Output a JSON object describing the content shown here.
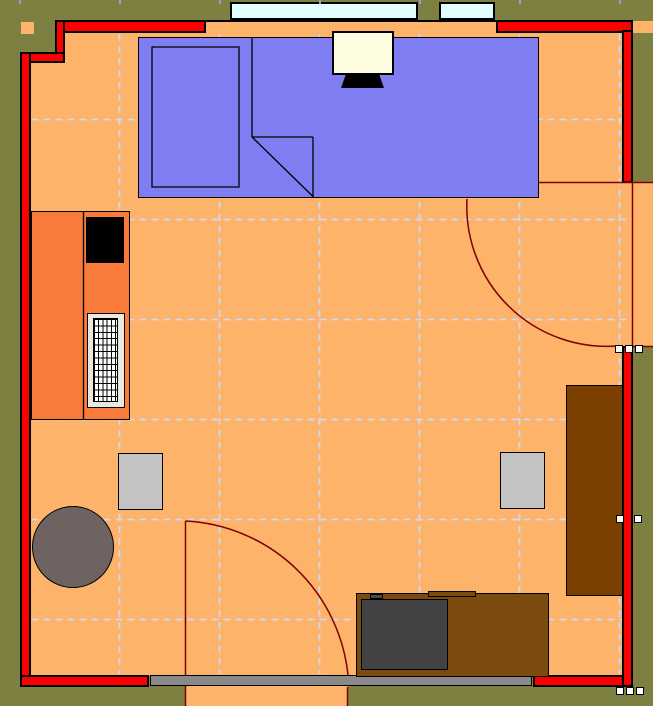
{
  "title": "Room floor plan",
  "canvas": {
    "w": 653,
    "h": 706,
    "bg": "#7d8041"
  },
  "palette": {
    "outside": "#7d8041",
    "floor": "#fdb36a",
    "wall_red": "#fa0000",
    "wall_outline": "#000000",
    "door_line": "#7f0000",
    "grid_line": "#cfd8f6",
    "ruler_tick": "#8f9ce8",
    "window_glass": "#e1ffff",
    "desk_blue": "#7e7ef2",
    "cabinet_orange": "#f87b3a",
    "wood_dark": "#7b4000",
    "wood_mid": "#7b4a0e",
    "chair_gray": "#c3c3c3",
    "tv_gray": "#424242",
    "table_taupe": "#6f6361",
    "monitor_cream": "#fffde1",
    "radiator_body": "#e9e9e0",
    "sill_gray": "#898989",
    "outlet_white": "#ffffff"
  },
  "floor_regions": [
    {
      "name": "floor-main",
      "inter": false,
      "x": 64,
      "y": 33,
      "w": 558.5,
      "h": 643,
      "fill": "#fdb36a",
      "bw": 0
    },
    {
      "name": "floor-left-strip",
      "inter": false,
      "x": 30.5,
      "y": 62,
      "w": 33.5,
      "h": 614,
      "fill": "#fdb36a",
      "bw": 0
    },
    {
      "name": "window-sill-band",
      "inter": false,
      "x": 203,
      "y": 21.5,
      "w": 294,
      "h": 15.5,
      "fill": "#fdb36a",
      "bw": 0
    },
    {
      "name": "doorway-right-floor",
      "inter": false,
      "x": 622,
      "y": 182,
      "w": 31,
      "h": 165,
      "fill": "#fdb36a",
      "bw": 0
    },
    {
      "name": "doorway-bottom-floor",
      "inter": false,
      "x": 185,
      "y": 686,
      "w": 163,
      "h": 20,
      "fill": "#fdb36a",
      "bw": 0
    },
    {
      "name": "floor-sliver-top-right",
      "inter": false,
      "x": 633,
      "y": 21,
      "w": 20,
      "h": 12,
      "fill": "#fdb36a",
      "bw": 0
    },
    {
      "name": "floor-square-top-left",
      "inter": false,
      "x": 20.5,
      "y": 21.5,
      "w": 13,
      "h": 12.5,
      "fill": "#fdb36a",
      "bw": 0
    }
  ],
  "grid": {
    "color": "#cfd8f6",
    "dash": "7 5",
    "width": 1.8,
    "v": [
      {
        "x": 119.5,
        "y1": 34,
        "y2": 674
      },
      {
        "x": 219.5,
        "y1": 34,
        "y2": 674
      },
      {
        "x": 319.5,
        "y1": 34,
        "y2": 674
      },
      {
        "x": 419.5,
        "y1": 34,
        "y2": 674
      },
      {
        "x": 519.5,
        "y1": 34,
        "y2": 674
      },
      {
        "x": 619.5,
        "y1": 34,
        "y2": 674
      }
    ],
    "h": [
      {
        "y": 119.5,
        "x1": 31.5,
        "x2": 622
      },
      {
        "y": 219.5,
        "x1": 31.5,
        "x2": 632
      },
      {
        "y": 319.5,
        "x1": 31.5,
        "x2": 632
      },
      {
        "y": 419.5,
        "x1": 31.5,
        "x2": 622
      },
      {
        "y": 519.5,
        "x1": 31.5,
        "x2": 622
      },
      {
        "y": 619.5,
        "x1": 31.5,
        "x2": 622
      }
    ]
  },
  "ruler_ticks": {
    "color": "#8f9ce8",
    "y": 0,
    "w": 2,
    "h": 4,
    "xs": [
      18.5,
      118.5,
      218.5,
      318.5,
      418.5,
      518.5,
      618.5
    ]
  },
  "walls": [
    {
      "name": "wall-top-left-segment",
      "inter": false,
      "x": 54.5,
      "y": 19.5,
      "w": 151,
      "h": 13,
      "fill": "#fa0000",
      "bw": 2
    },
    {
      "name": "wall-top-right-segment",
      "inter": false,
      "x": 496,
      "y": 19.5,
      "w": 137,
      "h": 13.5,
      "fill": "#fa0000",
      "bw": 2
    },
    {
      "name": "wall-corner-step-vertical",
      "inter": false,
      "x": 54.5,
      "y": 19.5,
      "w": 10,
      "h": 43,
      "fill": "#fa0000",
      "bw": 2
    },
    {
      "name": "wall-corner-step-horizontal",
      "inter": false,
      "x": 20,
      "y": 51.5,
      "w": 44.5,
      "h": 11,
      "fill": "#fa0000",
      "bw": 2
    },
    {
      "name": "wall-left",
      "inter": false,
      "x": 20,
      "y": 51.5,
      "w": 10.5,
      "h": 635.5,
      "fill": "#fa0000",
      "bw": 2
    },
    {
      "name": "wall-bottom-left-segment",
      "inter": false,
      "x": 20,
      "y": 674.5,
      "w": 128.5,
      "h": 12.5,
      "fill": "#fa0000",
      "bw": 2
    },
    {
      "name": "wall-bottom-right-segment",
      "inter": false,
      "x": 532.5,
      "y": 674.5,
      "w": 100,
      "h": 12.5,
      "fill": "#fa0000",
      "bw": 2
    },
    {
      "name": "wall-right-upper",
      "inter": false,
      "x": 621.5,
      "y": 30,
      "w": 11,
      "h": 152.5,
      "fill": "#fa0000",
      "bw": 2
    },
    {
      "name": "wall-right-lower",
      "inter": false,
      "x": 621.5,
      "y": 345.5,
      "w": 11,
      "h": 341.5,
      "fill": "#fa0000",
      "bw": 2
    },
    {
      "name": "window-band-top-border",
      "inter": false,
      "x": 203,
      "y": 19.5,
      "w": 294,
      "h": 2,
      "fill": "#000000",
      "bw": 0
    },
    {
      "name": "bottom-threshold-sill",
      "inter": false,
      "x": 149.5,
      "y": 674.5,
      "w": 382,
      "h": 11.5,
      "fill": "#898989",
      "bw": 1.5
    }
  ],
  "windows": [
    {
      "name": "window-large",
      "inter": true,
      "x": 229.5,
      "y": 1.5,
      "w": 188,
      "h": 18.5,
      "fill": "#e1ffff",
      "bw": 2
    },
    {
      "name": "window-small",
      "inter": true,
      "x": 439,
      "y": 1.5,
      "w": 56,
      "h": 18.5,
      "fill": "#e1ffff",
      "bw": 2
    }
  ],
  "furniture": [
    {
      "name": "desk-workstation",
      "inter": true,
      "x": 137.5,
      "y": 36.5,
      "w": 401,
      "h": 161,
      "fill": "#7e7ef2",
      "bw": 1.5
    },
    {
      "name": "monitor-screen",
      "inter": true,
      "x": 331.5,
      "y": 30.5,
      "w": 62,
      "h": 44,
      "fill": "#fffde1",
      "bw": 2
    },
    {
      "name": "cabinet-left",
      "inter": true,
      "x": 30.5,
      "y": 210.5,
      "w": 99,
      "h": 209,
      "fill": "#f87b3a",
      "bw": 1.5
    },
    {
      "name": "cabinet-black-box",
      "inter": false,
      "x": 85.5,
      "y": 216.5,
      "w": 38,
      "h": 46,
      "fill": "#000000",
      "bw": 0
    },
    {
      "name": "radiator-body",
      "inter": true,
      "x": 87,
      "y": 312.5,
      "w": 37.5,
      "h": 95,
      "fill": "#e9e9e0",
      "bw": 1.5
    },
    {
      "name": "radiator-grille",
      "inter": false,
      "x": 93,
      "y": 318,
      "w": 25,
      "h": 83.5,
      "fill": "",
      "bw": 1.2,
      "cls": "grille"
    },
    {
      "name": "chair-left",
      "inter": true,
      "x": 117.5,
      "y": 452.5,
      "w": 45,
      "h": 57,
      "fill": "#c3c3c3",
      "bw": 1.5
    },
    {
      "name": "chair-right",
      "inter": true,
      "x": 499.5,
      "y": 451.5,
      "w": 45.5,
      "h": 57,
      "fill": "#c3c3c3",
      "bw": 1.5
    },
    {
      "name": "round-table",
      "inter": true,
      "kind": "circle",
      "cx": 73,
      "cy": 547,
      "r": 41,
      "fill": "#6f6361",
      "bw": 1.5
    },
    {
      "name": "wardrobe-right",
      "inter": true,
      "x": 565.5,
      "y": 384.5,
      "w": 57,
      "h": 211,
      "fill": "#7b4000",
      "bw": 1.5
    },
    {
      "name": "tv-stand",
      "inter": true,
      "x": 355.5,
      "y": 592.5,
      "w": 193,
      "h": 84,
      "fill": "#7b4a0e",
      "bw": 1.5
    },
    {
      "name": "tv-stand-knob",
      "inter": false,
      "x": 370,
      "y": 593.5,
      "w": 13,
      "h": 5.5,
      "fill": "#4a4a4a",
      "bw": 1
    },
    {
      "name": "tv-stand-tab",
      "inter": false,
      "x": 427.5,
      "y": 590.5,
      "w": 48.5,
      "h": 6,
      "fill": "#7b4a0e",
      "bw": 1
    },
    {
      "name": "tv-screen",
      "inter": true,
      "x": 360.5,
      "y": 598.5,
      "w": 87,
      "h": 71,
      "fill": "#424242",
      "bw": 1.5
    }
  ],
  "overlay": [
    {
      "name": "desk-inner-rect",
      "inter": false,
      "type": "path",
      "d": "M152 47 H239 V187 H152 Z",
      "stroke": "#000000",
      "w": 1.3
    },
    {
      "name": "desk-divider-line",
      "inter": false,
      "type": "line",
      "x1": 252,
      "y1": 38,
      "x2": 252,
      "y2": 137,
      "stroke": "#000000",
      "w": 1.3
    },
    {
      "name": "desk-shelf-line",
      "inter": false,
      "type": "line",
      "x1": 252,
      "y1": 137,
      "x2": 313,
      "y2": 137,
      "stroke": "#000000",
      "w": 1.3
    },
    {
      "name": "desk-side-line",
      "inter": false,
      "type": "line",
      "x1": 313,
      "y1": 137,
      "x2": 313,
      "y2": 197,
      "stroke": "#000000",
      "w": 1.3
    },
    {
      "name": "desk-diagonal-line",
      "inter": false,
      "type": "line",
      "x1": 252,
      "y1": 137,
      "x2": 313,
      "y2": 196.5,
      "stroke": "#000000",
      "w": 1.3
    },
    {
      "name": "cabinet-divider-line",
      "inter": false,
      "type": "line",
      "x1": 83.5,
      "y1": 211,
      "x2": 83.5,
      "y2": 419,
      "stroke": "#000000",
      "w": 1.3
    },
    {
      "name": "monitor-stand",
      "inter": false,
      "type": "poly",
      "points": "346,74 379,74 384,88 341,88",
      "fill": "#000000"
    },
    {
      "name": "door-right-leaf-line",
      "inter": true,
      "type": "line",
      "x1": 538.5,
      "y1": 182.5,
      "x2": 653,
      "y2": 182.5,
      "stroke": "#7f0000",
      "w": 1.5
    },
    {
      "name": "door-right-closed-line",
      "inter": false,
      "type": "line",
      "x1": 632.5,
      "y1": 183,
      "x2": 632.5,
      "y2": 346,
      "stroke": "#7f0000",
      "w": 1.5
    },
    {
      "name": "door-right-jamb-line",
      "inter": false,
      "type": "line",
      "x1": 632,
      "y1": 346.5,
      "x2": 653,
      "y2": 346.5,
      "stroke": "#7f0000",
      "w": 1.5
    },
    {
      "name": "door-right-swing-arc",
      "inter": false,
      "type": "path",
      "d": "M467 199 A140 140 0 0 0 617 346",
      "stroke": "#7f0000",
      "w": 1.5
    },
    {
      "name": "door-bottom-leaf-line",
      "inter": true,
      "type": "line",
      "x1": 185.5,
      "y1": 521,
      "x2": 185.5,
      "y2": 675,
      "stroke": "#7f0000",
      "w": 1.5
    },
    {
      "name": "door-bottom-swing-arc",
      "inter": false,
      "type": "path",
      "d": "M185.5 521 A172 172 0 0 1 348 675",
      "stroke": "#7f0000",
      "w": 1.5
    },
    {
      "name": "door-bottom-jamb-left",
      "inter": false,
      "type": "line",
      "x1": 185.5,
      "y1": 686,
      "x2": 185.5,
      "y2": 706,
      "stroke": "#7f0000",
      "w": 1.5
    },
    {
      "name": "door-bottom-jamb-right",
      "inter": false,
      "type": "line",
      "x1": 347.5,
      "y1": 687,
      "x2": 347.5,
      "y2": 706,
      "stroke": "#7f0000",
      "w": 1.5
    }
  ],
  "outlets": {
    "size": 8,
    "fill": "#ffffff",
    "bw": 1.2,
    "items": [
      {
        "name": "outlet-right-door-1",
        "x": 614.5,
        "y": 344.5
      },
      {
        "name": "outlet-right-door-2",
        "x": 624.5,
        "y": 344.5
      },
      {
        "name": "outlet-right-door-3",
        "x": 634.5,
        "y": 344.5
      },
      {
        "name": "outlet-right-wall-1",
        "x": 615.5,
        "y": 514.5
      },
      {
        "name": "outlet-right-wall-2",
        "x": 633.5,
        "y": 514.5
      },
      {
        "name": "outlet-bottom-corner-1",
        "x": 615.5,
        "y": 686.5
      },
      {
        "name": "outlet-bottom-corner-2",
        "x": 625.5,
        "y": 686.5
      },
      {
        "name": "outlet-bottom-corner-3",
        "x": 635.5,
        "y": 686.5
      }
    ]
  }
}
